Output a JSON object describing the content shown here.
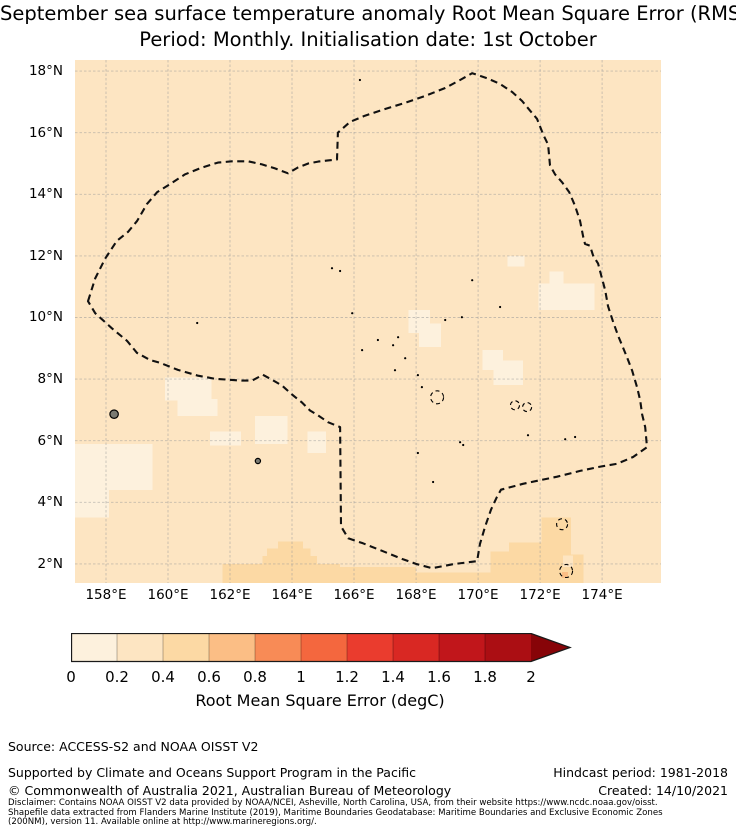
{
  "title": {
    "line1": "September sea surface temperature anomaly Root Mean Square Error (RMSE)",
    "line2": "Period: Monthly. Initialisation date: 1st October"
  },
  "footer": {
    "source": "Source: ACCESS-S2 and NOAA OISST V2",
    "supported": "Supported by Climate and Oceans Support Program in the Pacific",
    "copyright": "© Commonwealth of Australia 2021, Australian Bureau of Meteorology",
    "hindcast": "Hindcast period: 1981-2018",
    "created": "Created: 14/10/2021"
  },
  "disclaimer": {
    "line1": "Disclaimer: Contains NOAA OISST V2 data provided by NOAA/NCEI, Asheville, North Carolina, USA, from their website https://www.ncdc.noaa.gov/oisst.",
    "line2": "Shapefile data extracted from Flanders Marine Institute (2019), Maritime Boundaries Geodatabase: Maritime Boundaries and Exclusive Economic Zones",
    "line3": "(200NM), version 11. Available online at http://www.marineregions.org/."
  },
  "chart_data": {
    "type": "heatmap",
    "title": "September sea surface temperature anomaly Root Mean Square Error (RMSE)",
    "subtitle": "Period: Monthly. Initialisation date: 1st October",
    "projection": {
      "lon_min": 157.0,
      "lon_max": 175.9,
      "lat_min": 1.38,
      "lat_max": 18.36
    },
    "grid": true,
    "grid_color": "#9a9a9a",
    "x_ticks": [
      {
        "value": 158,
        "label": "158°E"
      },
      {
        "value": 160,
        "label": "160°E"
      },
      {
        "value": 162,
        "label": "162°E"
      },
      {
        "value": 164,
        "label": "164°E"
      },
      {
        "value": 166,
        "label": "166°E"
      },
      {
        "value": 168,
        "label": "168°E"
      },
      {
        "value": 170,
        "label": "170°E"
      },
      {
        "value": 172,
        "label": "172°E"
      },
      {
        "value": 174,
        "label": "174°E"
      }
    ],
    "y_ticks": [
      {
        "value": 18,
        "label": "18°N"
      },
      {
        "value": 16,
        "label": "16°N"
      },
      {
        "value": 14,
        "label": "14°N"
      },
      {
        "value": 12,
        "label": "12°N"
      },
      {
        "value": 10,
        "label": "10°N"
      },
      {
        "value": 8,
        "label": "8°N"
      },
      {
        "value": 6,
        "label": "6°N"
      },
      {
        "value": 4,
        "label": "4°N"
      },
      {
        "value": 2,
        "label": "2°N"
      }
    ],
    "colorbar": {
      "label": "Root Mean Square Error (degC)",
      "tick_labels": [
        "0",
        "0.2",
        "0.4",
        "0.6",
        "0.8",
        "1",
        "1.2",
        "1.4",
        "1.6",
        "1.8",
        "2"
      ],
      "bin_edges": [
        0,
        0.2,
        0.4,
        0.6,
        0.8,
        1.0,
        1.2,
        1.4,
        1.6,
        1.8,
        2.0
      ],
      "bin_colors": [
        "#fdf1dd",
        "#fde5c2",
        "#fcd9a4",
        "#fbbe85",
        "#f88b56",
        "#f4673e",
        "#ea3c2e",
        "#d92823",
        "#c1161b",
        "#ab0e13"
      ],
      "extend_max_color": "#870408",
      "outline_color": "#1a1a1a"
    },
    "field": {
      "base_bin": 1,
      "patches": [
        {
          "bin": 2,
          "lon": [
            161.75,
            165.55
          ],
          "lat": [
            1.38,
            2.0
          ]
        },
        {
          "bin": 2,
          "lon": [
            162.95,
            165.0
          ],
          "lat": [
            1.7,
            2.0
          ]
        },
        {
          "bin": 2,
          "lon": [
            163.05,
            164.8
          ],
          "lat": [
            2.0,
            2.26
          ]
        },
        {
          "bin": 2,
          "lon": [
            163.2,
            164.6
          ],
          "lat": [
            2.26,
            2.5
          ]
        },
        {
          "bin": 2,
          "lon": [
            163.55,
            164.35
          ],
          "lat": [
            2.5,
            2.72
          ]
        },
        {
          "bin": 2,
          "lon": [
            165.55,
            168.0
          ],
          "lat": [
            1.38,
            1.9
          ]
        },
        {
          "bin": 2,
          "lon": [
            168.0,
            170.4
          ],
          "lat": [
            1.38,
            1.72
          ]
        },
        {
          "bin": 2,
          "lon": [
            170.4,
            171.05
          ],
          "lat": [
            1.38,
            2.4
          ]
        },
        {
          "bin": 2,
          "lon": [
            171.0,
            173.0
          ],
          "lat": [
            1.38,
            2.7
          ]
        },
        {
          "bin": 2,
          "lon": [
            172.05,
            173.0
          ],
          "lat": [
            2.7,
            3.5
          ]
        },
        {
          "bin": 2,
          "lon": [
            173.0,
            173.4
          ],
          "lat": [
            1.38,
            2.3
          ]
        },
        {
          "bin": 1,
          "lon": [
            172.74,
            173.06
          ],
          "lat": [
            1.9,
            2.28
          ]
        },
        {
          "bin": 3,
          "lon": [
            172.71,
            172.9
          ],
          "lat": [
            1.54,
            1.73
          ]
        },
        {
          "bin": 0,
          "lon": [
            157.0,
            159.5
          ],
          "lat": [
            4.4,
            5.9
          ]
        },
        {
          "bin": 0,
          "lon": [
            157.0,
            158.1
          ],
          "lat": [
            3.5,
            4.45
          ]
        },
        {
          "bin": 0,
          "lon": [
            159.9,
            161.4
          ],
          "lat": [
            7.3,
            8.05
          ]
        },
        {
          "bin": 0,
          "lon": [
            160.3,
            161.6
          ],
          "lat": [
            6.8,
            7.35
          ]
        },
        {
          "bin": 0,
          "lon": [
            161.35,
            162.35
          ],
          "lat": [
            5.85,
            6.3
          ]
        },
        {
          "bin": 0,
          "lon": [
            162.8,
            163.85
          ],
          "lat": [
            5.9,
            6.8
          ]
        },
        {
          "bin": 0,
          "lon": [
            164.5,
            165.1
          ],
          "lat": [
            5.6,
            6.3
          ]
        },
        {
          "bin": 0,
          "lon": [
            167.75,
            168.45
          ],
          "lat": [
            9.5,
            10.25
          ]
        },
        {
          "bin": 0,
          "lon": [
            168.1,
            168.8
          ],
          "lat": [
            9.05,
            9.8
          ]
        },
        {
          "bin": 0,
          "lon": [
            170.15,
            170.8
          ],
          "lat": [
            8.3,
            8.95
          ]
        },
        {
          "bin": 0,
          "lon": [
            170.5,
            171.45
          ],
          "lat": [
            7.8,
            8.6
          ]
        },
        {
          "bin": 0,
          "lon": [
            170.95,
            171.5
          ],
          "lat": [
            11.65,
            12.0
          ]
        },
        {
          "bin": 0,
          "lon": [
            171.95,
            173.75
          ],
          "lat": [
            10.25,
            11.1
          ]
        },
        {
          "bin": 0,
          "lon": [
            172.3,
            172.75
          ],
          "lat": [
            11.1,
            11.5
          ]
        }
      ]
    },
    "eez_boundary": {
      "style": "dashed",
      "color": "#111111",
      "points": [
        [
          157.42,
          10.53
        ],
        [
          157.65,
          11.27
        ],
        [
          157.97,
          11.91
        ],
        [
          158.35,
          12.49
        ],
        [
          158.71,
          12.78
        ],
        [
          159.0,
          13.13
        ],
        [
          159.32,
          13.68
        ],
        [
          159.65,
          14.07
        ],
        [
          160.0,
          14.29
        ],
        [
          160.55,
          14.65
        ],
        [
          161.1,
          14.87
        ],
        [
          161.61,
          15.03
        ],
        [
          162.06,
          15.07
        ],
        [
          162.58,
          15.07
        ],
        [
          163.03,
          14.97
        ],
        [
          163.45,
          14.84
        ],
        [
          163.87,
          14.68
        ],
        [
          164.19,
          14.87
        ],
        [
          164.52,
          15.0
        ],
        [
          164.84,
          15.06
        ],
        [
          165.16,
          15.1
        ],
        [
          165.45,
          15.13
        ],
        [
          165.48,
          16.0
        ],
        [
          165.87,
          16.35
        ],
        [
          166.35,
          16.55
        ],
        [
          167.0,
          16.77
        ],
        [
          167.65,
          16.97
        ],
        [
          168.29,
          17.19
        ],
        [
          168.94,
          17.45
        ],
        [
          169.42,
          17.71
        ],
        [
          169.81,
          17.93
        ],
        [
          170.29,
          17.77
        ],
        [
          170.71,
          17.58
        ],
        [
          171.1,
          17.32
        ],
        [
          171.42,
          17.03
        ],
        [
          171.68,
          16.71
        ],
        [
          171.9,
          16.45
        ],
        [
          172.1,
          15.94
        ],
        [
          172.26,
          15.61
        ],
        [
          172.32,
          14.94
        ],
        [
          172.48,
          14.65
        ],
        [
          172.71,
          14.39
        ],
        [
          172.94,
          14.07
        ],
        [
          173.13,
          13.62
        ],
        [
          173.29,
          13.13
        ],
        [
          173.39,
          12.62
        ],
        [
          173.45,
          12.39
        ],
        [
          173.61,
          12.33
        ],
        [
          173.71,
          12.01
        ],
        [
          173.87,
          11.75
        ],
        [
          173.94,
          11.49
        ],
        [
          174.1,
          10.88
        ],
        [
          174.19,
          10.37
        ],
        [
          174.35,
          9.88
        ],
        [
          174.52,
          9.4
        ],
        [
          174.68,
          9.01
        ],
        [
          174.81,
          8.69
        ],
        [
          174.97,
          8.27
        ],
        [
          175.13,
          7.73
        ],
        [
          175.23,
          7.31
        ],
        [
          175.29,
          6.86
        ],
        [
          175.39,
          6.44
        ],
        [
          175.45,
          5.79
        ],
        [
          175.0,
          5.47
        ],
        [
          174.48,
          5.25
        ],
        [
          173.9,
          5.15
        ],
        [
          173.29,
          5.02
        ],
        [
          172.55,
          4.83
        ],
        [
          172.06,
          4.73
        ],
        [
          171.45,
          4.6
        ],
        [
          170.74,
          4.41
        ],
        [
          170.61,
          4.18
        ],
        [
          170.42,
          3.77
        ],
        [
          170.23,
          3.22
        ],
        [
          170.06,
          2.64
        ],
        [
          169.97,
          2.09
        ],
        [
          169.19,
          1.99
        ],
        [
          168.52,
          1.86
        ],
        [
          168.03,
          1.99
        ],
        [
          167.58,
          2.15
        ],
        [
          166.94,
          2.41
        ],
        [
          166.29,
          2.67
        ],
        [
          165.81,
          2.83
        ],
        [
          165.58,
          3.22
        ],
        [
          165.55,
          6.44
        ],
        [
          165.48,
          6.47
        ],
        [
          165.16,
          6.6
        ],
        [
          164.84,
          6.82
        ],
        [
          164.58,
          6.98
        ],
        [
          164.32,
          7.24
        ],
        [
          164.0,
          7.5
        ],
        [
          163.68,
          7.79
        ],
        [
          163.35,
          7.98
        ],
        [
          163.06,
          8.14
        ],
        [
          162.71,
          7.95
        ],
        [
          162.39,
          7.95
        ],
        [
          161.94,
          7.98
        ],
        [
          161.52,
          8.01
        ],
        [
          160.97,
          8.11
        ],
        [
          160.32,
          8.3
        ],
        [
          159.74,
          8.53
        ],
        [
          159.42,
          8.62
        ],
        [
          159.0,
          8.85
        ],
        [
          158.68,
          9.24
        ],
        [
          158.19,
          9.65
        ],
        [
          157.65,
          10.14
        ]
      ]
    },
    "islands": {
      "filled": [
        {
          "name": "pohnpei",
          "lon": 158.26,
          "lat": 6.86,
          "r": 4.2
        },
        {
          "name": "kosrae",
          "lon": 162.9,
          "lat": 5.34,
          "r": 2.6
        }
      ],
      "atoll_outlines": [
        {
          "lon": 168.68,
          "lat": 7.41,
          "r": 6.5
        },
        {
          "lon": 171.19,
          "lat": 7.15,
          "r": 4.5
        },
        {
          "lon": 171.58,
          "lat": 7.09,
          "r": 4.5
        },
        {
          "lon": 172.71,
          "lat": 3.29,
          "r": 5.5
        },
        {
          "lon": 172.84,
          "lat": 1.77,
          "r": 6.5
        }
      ],
      "dots": [
        [
          165.94,
          10.14
        ],
        [
          166.77,
          9.27
        ],
        [
          167.26,
          9.1
        ],
        [
          167.42,
          9.36
        ],
        [
          166.26,
          8.94
        ],
        [
          167.65,
          8.68
        ],
        [
          167.32,
          8.29
        ],
        [
          168.06,
          8.13
        ],
        [
          168.19,
          7.74
        ],
        [
          169.42,
          5.95
        ],
        [
          169.52,
          5.86
        ],
        [
          168.06,
          5.6
        ],
        [
          168.55,
          4.66
        ],
        [
          165.29,
          11.6
        ],
        [
          165.55,
          11.51
        ],
        [
          169.81,
          11.21
        ],
        [
          168.94,
          9.92
        ],
        [
          169.48,
          10.01
        ],
        [
          171.61,
          6.18
        ],
        [
          170.71,
          10.34
        ],
        [
          166.19,
          17.71
        ],
        [
          160.94,
          9.82
        ],
        [
          172.81,
          6.05
        ],
        [
          173.13,
          6.12
        ]
      ]
    }
  }
}
